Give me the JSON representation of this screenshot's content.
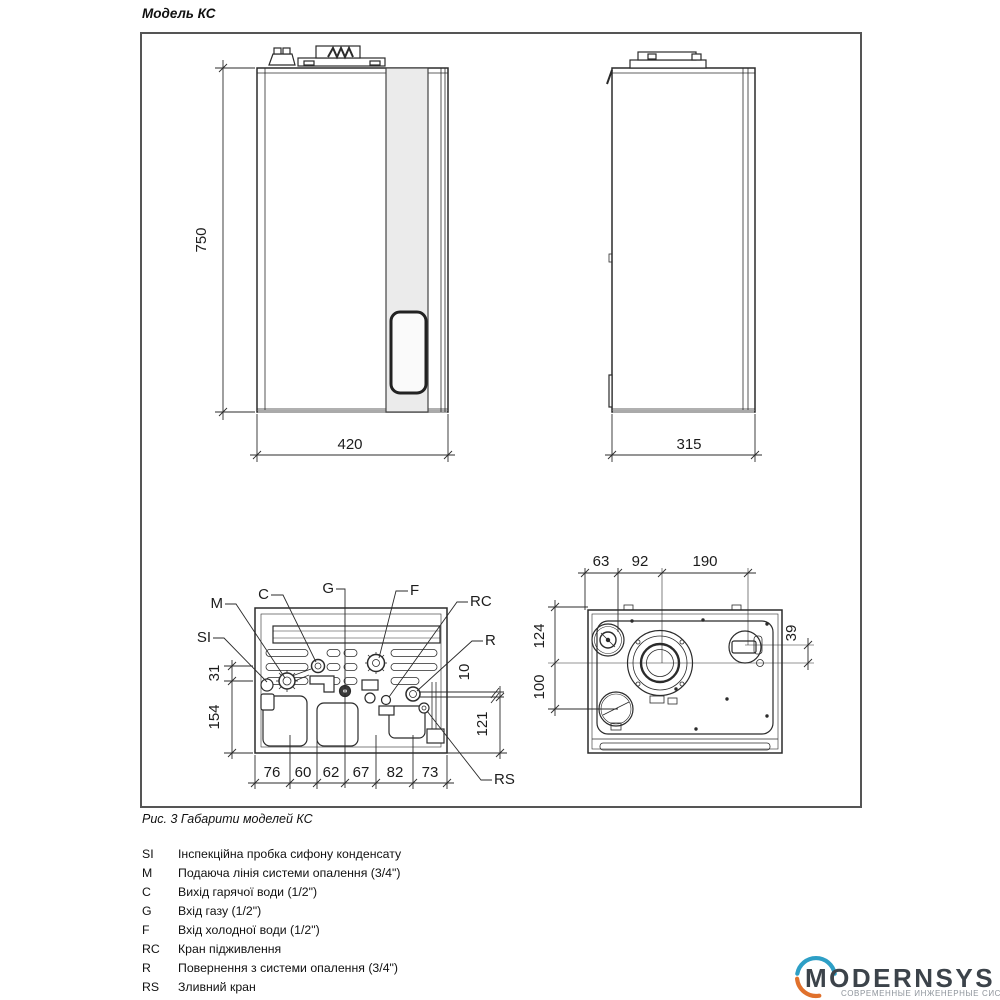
{
  "page": {
    "title": "Модель КС",
    "caption": "Рис. 3 Габарити моделей КС"
  },
  "diagram": {
    "front_view": {
      "height": "750",
      "width": "420"
    },
    "side_view": {
      "depth": "315"
    },
    "bottom_view": {
      "ports": {
        "si": "SI",
        "m": "M",
        "c": "C",
        "g": "G",
        "f": "F",
        "rc": "RC",
        "r": "R",
        "rs": "RS"
      },
      "dims_left": [
        "31",
        "154"
      ],
      "dims_right": [
        "10",
        "121"
      ],
      "dims_bottom": [
        "76",
        "60",
        "62",
        "67",
        "82",
        "73"
      ]
    },
    "top_view": {
      "dims_top": [
        "63",
        "92",
        "190"
      ],
      "dims_left": [
        "124",
        "100"
      ],
      "dims_right": [
        "39"
      ]
    }
  },
  "legend": [
    {
      "key": "SI",
      "text": "Інспекційна пробка сифону конденсату"
    },
    {
      "key": "M",
      "text": "Подаюча лінія системи опалення (3/4\")"
    },
    {
      "key": "C",
      "text": "Вихід гарячої води (1/2\")"
    },
    {
      "key": "G",
      "text": "Вхід газу (1/2\")"
    },
    {
      "key": "F",
      "text": "Вхід холодної води (1/2\")"
    },
    {
      "key": "RC",
      "text": "Кран підживлення"
    },
    {
      "key": "R",
      "text": "Повернення з системи опалення (3/4\")"
    },
    {
      "key": "RS",
      "text": "Зливний кран"
    }
  ],
  "logo": {
    "name": "MODERNSYS",
    "tagline": "СОВРЕМЕННЫЕ ИНЖЕНЕРНЫЕ СИСТЕМЫ"
  },
  "colors": {
    "line": "#2b2b2b",
    "frame_border": "#555555",
    "panel_gray": "#ebebeb",
    "logo_text": "#3c434a",
    "logo_teal": "#2d9fc6",
    "logo_orange": "#e0712c",
    "tagline_gray": "#8e949b"
  }
}
